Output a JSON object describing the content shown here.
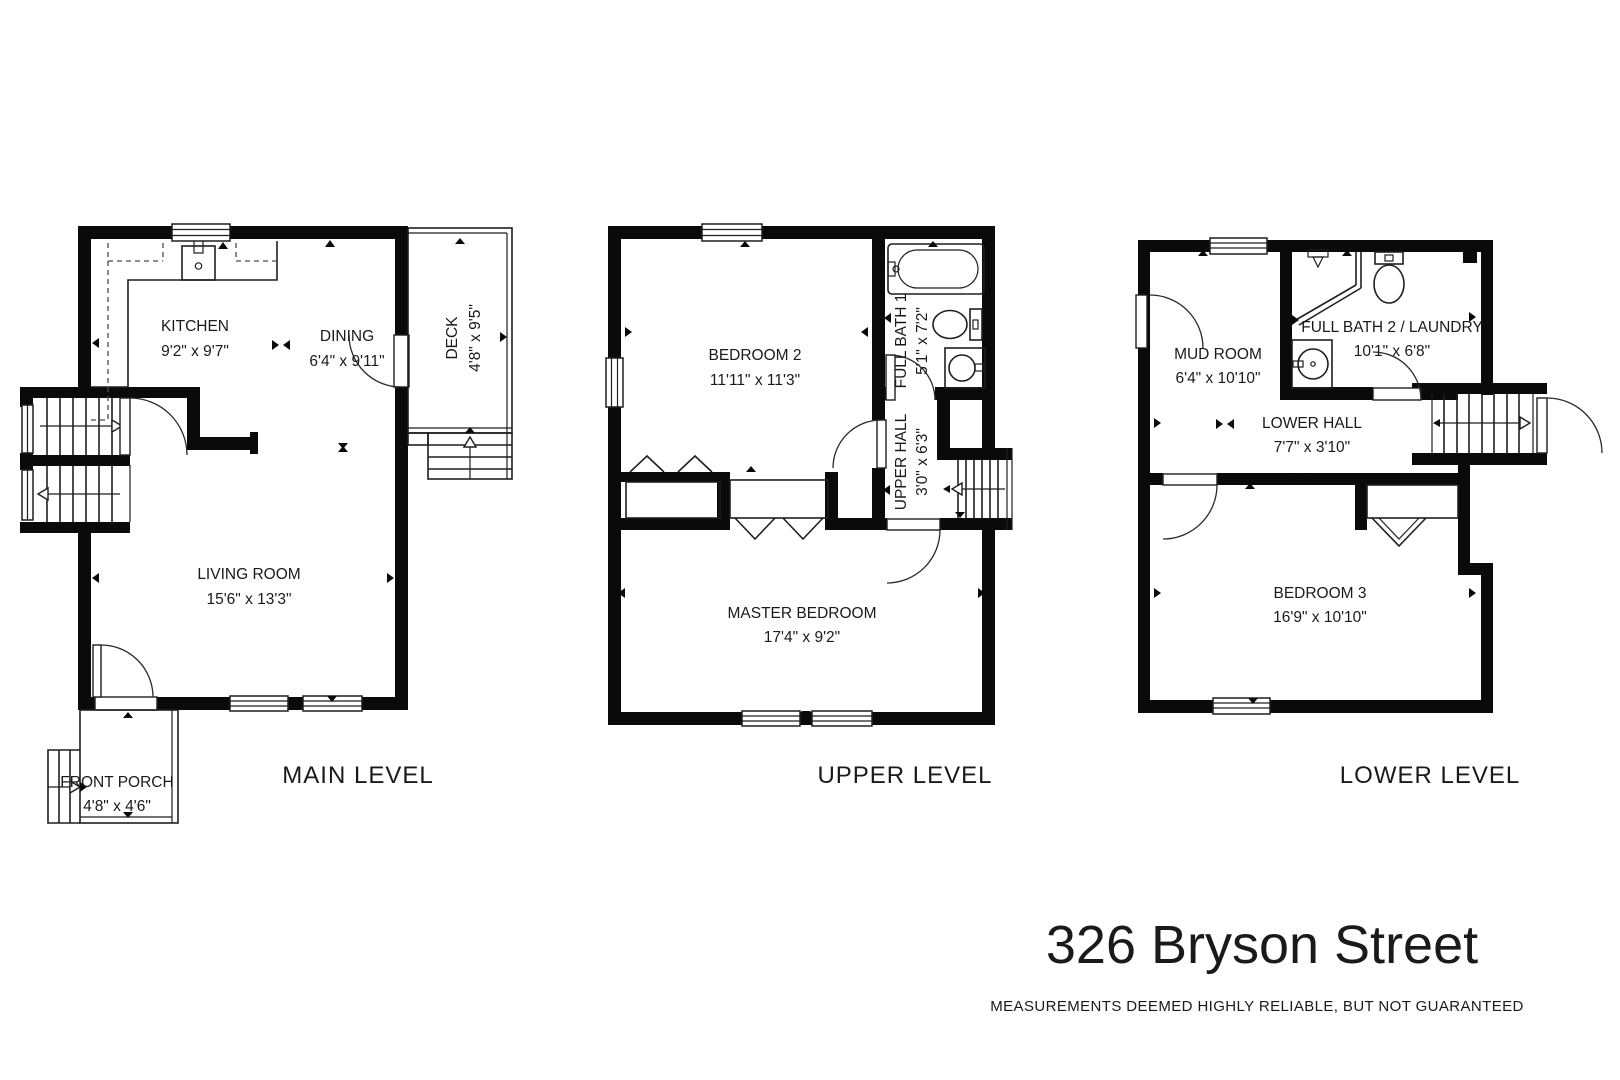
{
  "title": {
    "text": "326 Bryson Street",
    "disclaimer": "MEASUREMENTS DEEMED HIGHLY RELIABLE, BUT NOT GUARANTEED"
  },
  "levels": [
    {
      "id": "main",
      "label": "MAIN LEVEL",
      "rooms": [
        {
          "name": "KITCHEN",
          "dims": "9'2\" x 9'7\""
        },
        {
          "name": "DINING",
          "dims": "6'4\" x 9'11\""
        },
        {
          "name": "LIVING ROOM",
          "dims": "15'6\" x 13'3\""
        },
        {
          "name": "FRONT PORCH",
          "dims": "4'8\" x 4'6\""
        },
        {
          "name": "DECK",
          "dims": "4'8\" x 9'5\""
        }
      ]
    },
    {
      "id": "upper",
      "label": "UPPER LEVEL",
      "rooms": [
        {
          "name": "BEDROOM 2",
          "dims": "11'11\" x 11'3\""
        },
        {
          "name": "FULL BATH 1",
          "dims": "5'1\" x 7'2\""
        },
        {
          "name": "UPPER HALL",
          "dims": "3'0\" x 6'3\""
        },
        {
          "name": "MASTER BEDROOM",
          "dims": "17'4\" x 9'2\""
        }
      ]
    },
    {
      "id": "lower",
      "label": "LOWER LEVEL",
      "rooms": [
        {
          "name": "MUD ROOM",
          "dims": "6'4\" x 10'10\""
        },
        {
          "name": "FULL BATH 2 / LAUNDRY",
          "dims": "10'1\" x 6'8\""
        },
        {
          "name": "LOWER HALL",
          "dims": "7'7\" x 3'10\""
        },
        {
          "name": "BEDROOM 3",
          "dims": "16'9\" x 10'10\""
        }
      ]
    }
  ]
}
